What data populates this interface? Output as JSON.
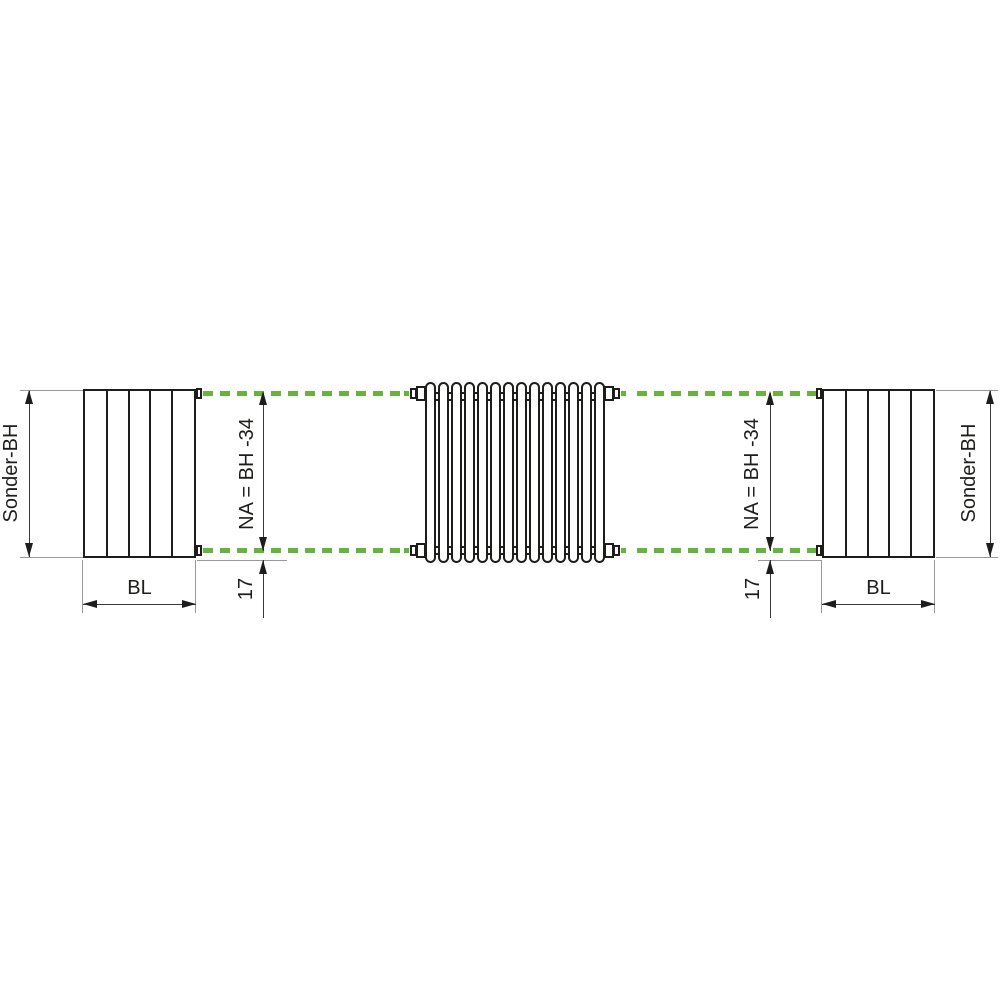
{
  "diagram": {
    "type": "radiator-dimension-drawing",
    "labels": {
      "left_height": "Sonder-BH",
      "left_length": "BL",
      "left_hub": "NA = BH -34",
      "left_offset": "17",
      "right_height": "Sonder-BH",
      "right_length": "BL",
      "right_hub": "NA = BH -34",
      "right_offset": "17"
    },
    "colors": {
      "accent_green": "#66b43c",
      "line_black": "#1d1d1b",
      "extension_gray": "#999999"
    },
    "radiator": {
      "tube_count": 14
    },
    "blocks": {
      "panel_count": 5
    }
  }
}
